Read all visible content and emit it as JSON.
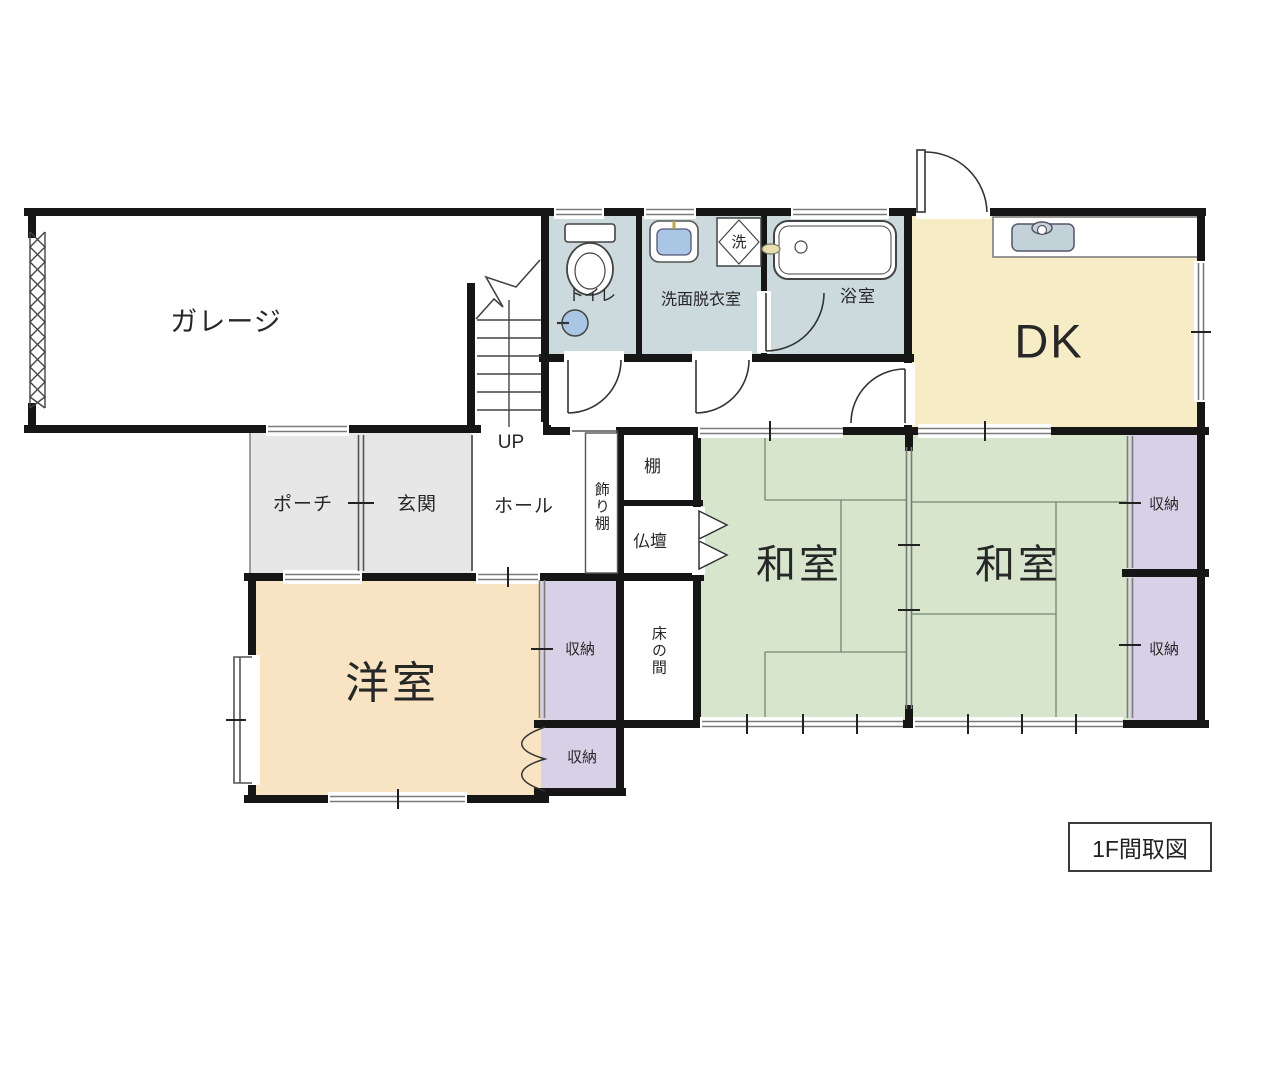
{
  "title_box": {
    "label": "1F間取図"
  },
  "colors": {
    "wall": "#161616",
    "wet_room": "#ccd9dd",
    "dk": "#f6ecc5",
    "tatami": "#d6e5cc",
    "storage": "#d8d0e7",
    "western_room": "#f8e4c3",
    "porch": "#e7e7e7",
    "fixture_blue": "#a9c6e4",
    "counter_sink": "#c3d2d8"
  },
  "rooms": {
    "garage": {
      "label": "ガレージ"
    },
    "toilet": {
      "label": "トイレ"
    },
    "washroom": {
      "label": "洗面脱衣室"
    },
    "laundry": {
      "label": "洗"
    },
    "bathroom": {
      "label": "浴室"
    },
    "dk": {
      "label": "DK"
    },
    "porch": {
      "label": "ポーチ"
    },
    "entrance": {
      "label": "玄関"
    },
    "hall": {
      "label": "ホール"
    },
    "stairs": {
      "label": "UP"
    },
    "display_shelf": {
      "label": "飾り棚"
    },
    "shelf": {
      "label": "棚"
    },
    "butsudan": {
      "label": "仏壇"
    },
    "tokonoma": {
      "label": "床の間"
    },
    "japanese_room_1": {
      "label": "和室"
    },
    "japanese_room_2": {
      "label": "和室"
    },
    "western_room": {
      "label": "洋室"
    },
    "storage_top_right": {
      "label": "収納"
    },
    "storage_bottom_right": {
      "label": "収納"
    },
    "storage_mid_top": {
      "label": "収納"
    },
    "storage_mid_bottom": {
      "label": "収納"
    }
  }
}
